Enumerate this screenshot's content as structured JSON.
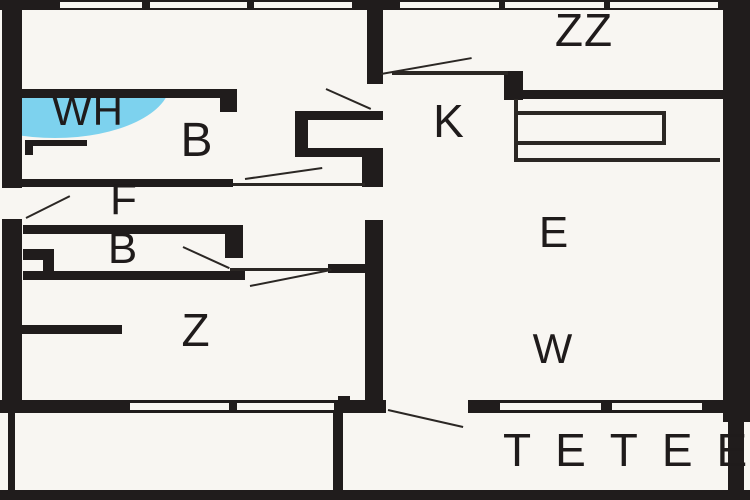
{
  "plan": {
    "canvas": {
      "width": 750,
      "height": 500
    },
    "colors": {
      "background": "#f8f6f2",
      "wall": "#201c1c",
      "line": "#2b2724",
      "blue": "#7dd2ee",
      "text": "#1f1b1b"
    },
    "rooms": [
      {
        "id": "zz",
        "label": "ZZ",
        "cx": 584,
        "cy": 30,
        "size": 46
      },
      {
        "id": "wh",
        "label": "WH",
        "cx": 88,
        "cy": 111,
        "size": 42
      },
      {
        "id": "b1",
        "label": "B",
        "cx": 197,
        "cy": 141,
        "size": 48
      },
      {
        "id": "k",
        "label": "K",
        "cx": 449,
        "cy": 121,
        "size": 46
      },
      {
        "id": "f",
        "label": "F",
        "cx": 124,
        "cy": 200,
        "size": 44
      },
      {
        "id": "b2",
        "label": "B",
        "cx": 123,
        "cy": 249,
        "size": 44
      },
      {
        "id": "z",
        "label": "Z",
        "cx": 196,
        "cy": 330,
        "size": 46
      },
      {
        "id": "e",
        "label": "E",
        "cx": 554,
        "cy": 233,
        "size": 44
      },
      {
        "id": "w",
        "label": "W",
        "cx": 553,
        "cy": 349,
        "size": 42
      }
    ],
    "terrace_label": {
      "text": "TETEE",
      "x": 503,
      "y": 427,
      "size": 46,
      "letter_spacing": 24
    },
    "walls": [
      {
        "x": 0,
        "y": 0,
        "w": 750,
        "h": 10
      },
      {
        "x": 2,
        "y": 0,
        "w": 20,
        "h": 400
      },
      {
        "x": 723,
        "y": 0,
        "w": 27,
        "h": 422
      },
      {
        "x": 0,
        "y": 400,
        "w": 750,
        "h": 13
      },
      {
        "x": 0,
        "y": 490,
        "w": 750,
        "h": 10
      },
      {
        "x": 8,
        "y": 413,
        "w": 7,
        "h": 80
      },
      {
        "x": 333,
        "y": 413,
        "w": 10,
        "h": 80
      },
      {
        "x": 728,
        "y": 413,
        "w": 16,
        "h": 79
      },
      {
        "x": 367,
        "y": 0,
        "w": 16,
        "h": 84
      },
      {
        "x": 504,
        "y": 71,
        "w": 19,
        "h": 29
      },
      {
        "x": 512,
        "y": 90,
        "w": 238,
        "h": 9
      },
      {
        "x": 22,
        "y": 89,
        "w": 213,
        "h": 9
      },
      {
        "x": 220,
        "y": 89,
        "w": 17,
        "h": 23
      },
      {
        "x": 295,
        "y": 111,
        "w": 88,
        "h": 9
      },
      {
        "x": 295,
        "y": 111,
        "w": 13,
        "h": 46
      },
      {
        "x": 308,
        "y": 148,
        "w": 75,
        "h": 9
      },
      {
        "x": 362,
        "y": 148,
        "w": 21,
        "h": 39
      },
      {
        "x": 22,
        "y": 179,
        "w": 211,
        "h": 8
      },
      {
        "x": 23,
        "y": 225,
        "w": 205,
        "h": 9
      },
      {
        "x": 225,
        "y": 225,
        "w": 18,
        "h": 33
      },
      {
        "x": 23,
        "y": 249,
        "w": 31,
        "h": 11
      },
      {
        "x": 43,
        "y": 249,
        "w": 11,
        "h": 24
      },
      {
        "x": 23,
        "y": 271,
        "w": 222,
        "h": 9
      },
      {
        "x": 22,
        "y": 325,
        "w": 100,
        "h": 9
      },
      {
        "x": 365,
        "y": 220,
        "w": 18,
        "h": 193
      },
      {
        "x": 328,
        "y": 264,
        "w": 38,
        "h": 9
      },
      {
        "x": 338,
        "y": 396,
        "w": 12,
        "h": 17
      }
    ],
    "openings": [
      {
        "x": 2,
        "y": 188,
        "w": 20,
        "h": 31
      },
      {
        "x": 386,
        "y": 400,
        "w": 82,
        "h": 13
      }
    ],
    "windows": [
      {
        "x": 60,
        "y": 2,
        "w": 82,
        "h": 6
      },
      {
        "x": 150,
        "y": 2,
        "w": 97,
        "h": 6
      },
      {
        "x": 254,
        "y": 2,
        "w": 98,
        "h": 6
      },
      {
        "x": 400,
        "y": 2,
        "w": 99,
        "h": 6
      },
      {
        "x": 505,
        "y": 2,
        "w": 99,
        "h": 6
      },
      {
        "x": 610,
        "y": 2,
        "w": 108,
        "h": 6
      },
      {
        "x": 130,
        "y": 403,
        "w": 99,
        "h": 7
      },
      {
        "x": 237,
        "y": 403,
        "w": 97,
        "h": 7
      },
      {
        "x": 500,
        "y": 403,
        "w": 101,
        "h": 7
      },
      {
        "x": 612,
        "y": 403,
        "w": 90,
        "h": 7
      }
    ],
    "thin_lines": [
      {
        "x": 392,
        "y": 71,
        "w": 116,
        "h": 4
      },
      {
        "x": 514,
        "y": 99,
        "w": 4,
        "h": 62
      },
      {
        "x": 514,
        "y": 111,
        "w": 152,
        "h": 4
      },
      {
        "x": 662,
        "y": 111,
        "w": 4,
        "h": 34
      },
      {
        "x": 514,
        "y": 141,
        "w": 152,
        "h": 4
      },
      {
        "x": 514,
        "y": 158,
        "w": 206,
        "h": 4
      },
      {
        "x": 233,
        "y": 183,
        "w": 132,
        "h": 3
      },
      {
        "x": 230,
        "y": 268,
        "w": 100,
        "h": 3
      }
    ],
    "door_swings": [
      {
        "x1": 381,
        "y1": 73,
        "x2": 472,
        "y2": 57
      },
      {
        "x1": 326,
        "y1": 88,
        "x2": 371,
        "y2": 108
      },
      {
        "x1": 26,
        "y1": 217,
        "x2": 70,
        "y2": 195
      },
      {
        "x1": 245,
        "y1": 178,
        "x2": 322,
        "y2": 167
      },
      {
        "x1": 183,
        "y1": 246,
        "x2": 229,
        "y2": 267
      },
      {
        "x1": 250,
        "y1": 285,
        "x2": 331,
        "y2": 269
      },
      {
        "x1": 388,
        "y1": 409,
        "x2": 463,
        "y2": 426
      }
    ],
    "wh_highlight": {
      "clip": {
        "x": 22,
        "y": 93,
        "w": 208,
        "h": 50
      },
      "ellipse": {
        "x": -82,
        "y": -65,
        "w": 230,
        "h": 110
      }
    },
    "wh_fixture": {
      "outer": {
        "x": 25,
        "y": 140,
        "w": 62,
        "h": 15
      },
      "inner": {
        "x": 33,
        "y": 146,
        "w": 55,
        "h": 9
      }
    }
  }
}
